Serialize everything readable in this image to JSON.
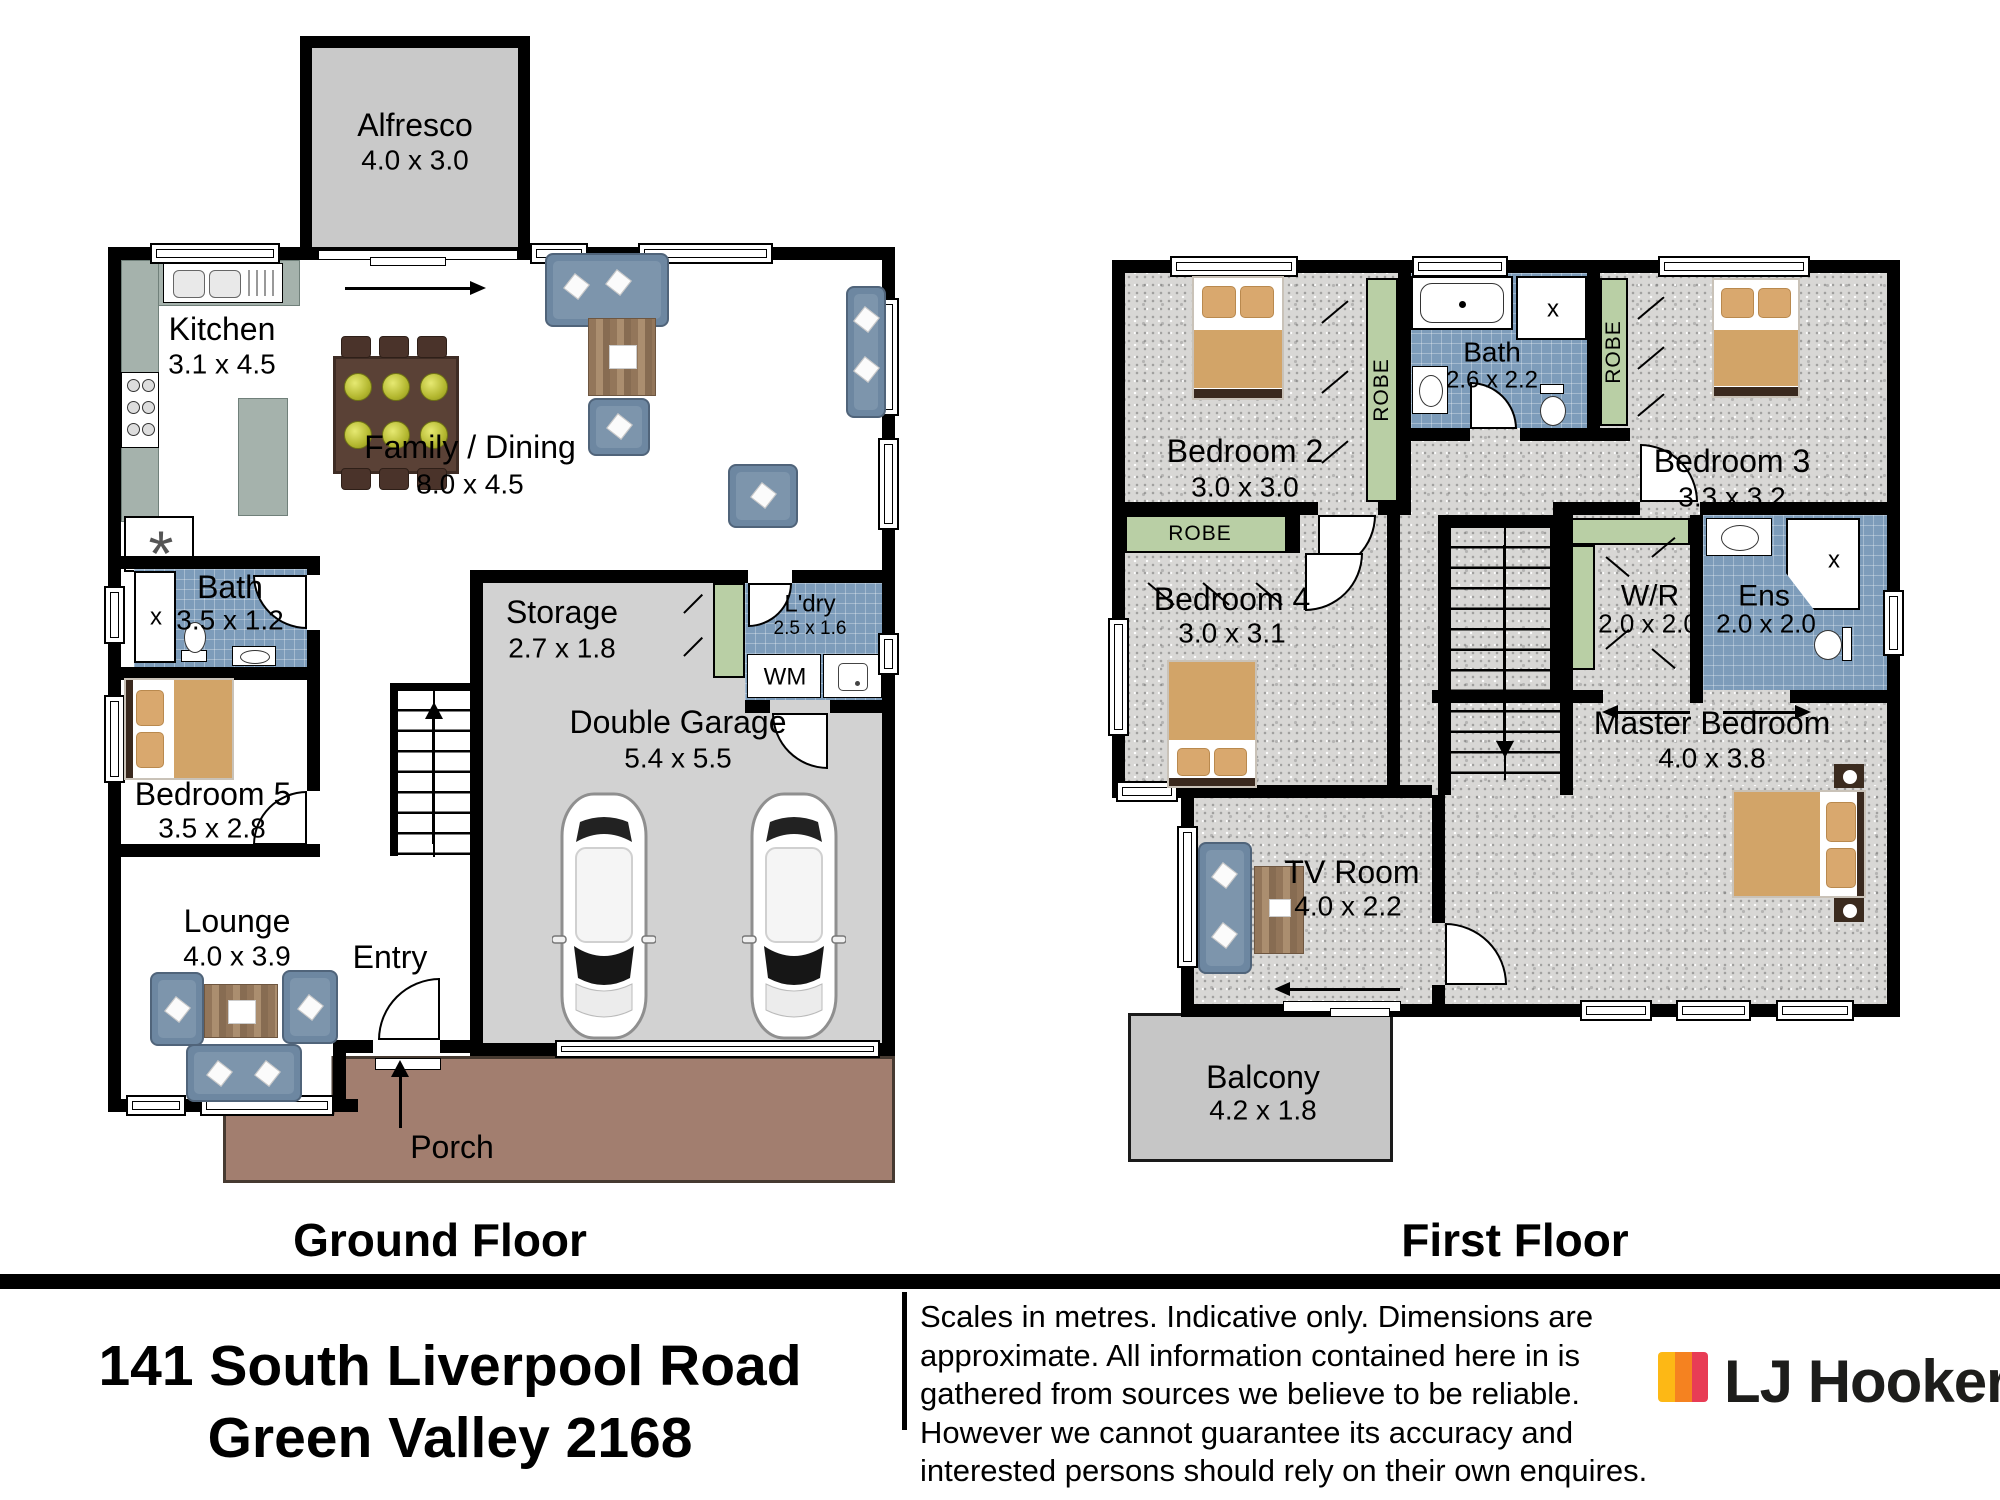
{
  "address": {
    "line1": "141 South Liverpool Road",
    "line2": "Green Valley 2168"
  },
  "disclaimer": {
    "l1": "Scales in metres. Indicative only. Dimensions are",
    "l2": "approximate. All information contained here in is",
    "l3": "gathered from sources we believe to be reliable.",
    "l4": "However we cannot guarantee its accuracy and",
    "l5": "interested persons should rely on their own enquires."
  },
  "brand": {
    "name": "LJ Hooker"
  },
  "colors": {
    "robe": "#b9cfa5",
    "tile": "#7d9cba",
    "carpet": "#d8d7d5",
    "slab": "#d2d2d2",
    "alfresco": "#c9c9c9",
    "balcony": "#c6c6c6",
    "porch": "#a27e6f",
    "counter": "#a5b2ac",
    "sofa": "#6d87a1",
    "timber": "#5a4136",
    "blanket": "#d2a468",
    "brand_yellow": "#FDB815",
    "brand_orange": "#F58220",
    "brand_red": "#E83C55"
  },
  "ground": {
    "title": "Ground Floor",
    "alfresco": {
      "name": "Alfresco",
      "dims": "4.0 x 3.0"
    },
    "kitchen": {
      "name": "Kitchen",
      "dims": "3.1 x 4.5"
    },
    "family": {
      "name": "Family / Dining",
      "dims": "8.0 x 4.5"
    },
    "bath": {
      "name": "Bath",
      "dims": "3.5 x 1.2"
    },
    "bed5": {
      "name": "Bedroom 5",
      "dims": "3.5 x 2.8"
    },
    "lounge": {
      "name": "Lounge",
      "dims": "4.0 x 3.9"
    },
    "entry": {
      "name": "Entry"
    },
    "storage": {
      "name": "Storage",
      "dims": "2.7 x 1.8"
    },
    "ldry": {
      "name": "L'dry",
      "dims": "2.5 x 1.6",
      "wm": "WM"
    },
    "garage": {
      "name": "Double Garage",
      "dims": "5.4 x 5.5"
    },
    "porch": {
      "name": "Porch"
    }
  },
  "first": {
    "title": "First Floor",
    "bed2": {
      "name": "Bedroom 2",
      "dims": "3.0 x 3.0"
    },
    "bath": {
      "name": "Bath",
      "dims": "2.6 x 2.2"
    },
    "bed3": {
      "name": "Bedroom 3",
      "dims": "3.3 x 3.2"
    },
    "bed4": {
      "name": "Bedroom 4",
      "dims": "3.0 x 3.1"
    },
    "wr": {
      "name": "W/R",
      "dims": "2.0 x 2.0"
    },
    "ens": {
      "name": "Ens",
      "dims": "2.0 x 2.0"
    },
    "master": {
      "name": "Master Bedroom",
      "dims": "4.0 x 3.8"
    },
    "tv": {
      "name": "TV Room",
      "dims": "4.0 x 2.2"
    },
    "balcony": {
      "name": "Balcony",
      "dims": "4.2 x 1.8"
    },
    "robe": "ROBE"
  },
  "fixtures": {
    "shower_x": "x",
    "pantry_star": "*"
  }
}
